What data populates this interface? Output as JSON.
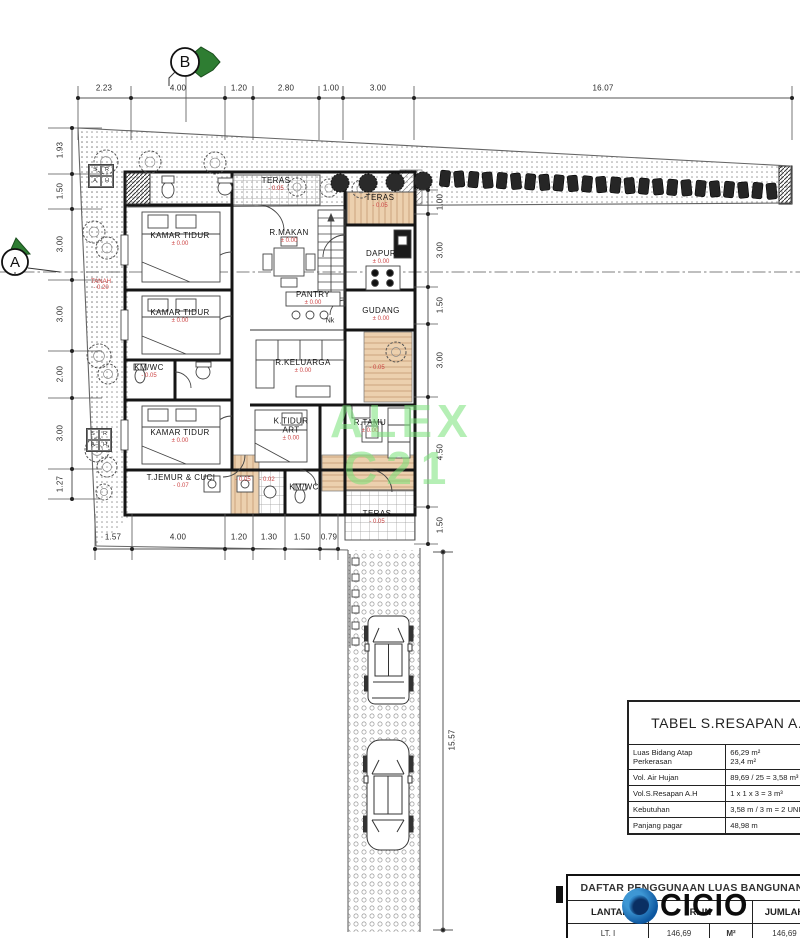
{
  "markers": {
    "a": "A",
    "b": "B"
  },
  "dims": {
    "top": [
      "2.23",
      "4.00",
      "1.20",
      "2.80",
      "1.00",
      "3.00",
      "16.07"
    ],
    "left": [
      "1.93",
      "1.50",
      "3.00",
      "3.00",
      "2.00",
      "3.00",
      "1.27"
    ],
    "right": [
      "1.00",
      "3.00",
      "1.50",
      "3.00",
      "4.50",
      "1.50"
    ],
    "bottom": [
      "1.57",
      "4.00",
      "1.20",
      "1.30",
      "1.50",
      "0.79"
    ],
    "driveway": "15.57"
  },
  "rooms": [
    {
      "name": "TERAS",
      "level": "- 0.05"
    },
    {
      "name": "R.MAKAN",
      "level": "± 0.00"
    },
    {
      "name": "TERAS",
      "level": "- 0.05"
    },
    {
      "name": "DAPUR",
      "level": "± 0.00"
    },
    {
      "name": "KAMAR TIDUR",
      "level": "± 0.00"
    },
    {
      "name": "PANTRY",
      "level": "± 0.00"
    },
    {
      "name": "KAMAR TIDUR",
      "level": "± 0.00"
    },
    {
      "name": "GUDANG",
      "level": "± 0.00"
    },
    {
      "name": "KM/WC",
      "level": "- 0.05"
    },
    {
      "name": "R.KELUARGA",
      "level": "± 0.00"
    },
    {
      "name": "KAMAR TIDUR",
      "level": "± 0.00"
    },
    {
      "name": "K.TIDUR ART",
      "level": "± 0.00"
    },
    {
      "name": "R.TAMU",
      "level": "± 0.00"
    },
    {
      "name": "T.JEMUR & CUCI",
      "level": "- 0.07"
    },
    {
      "name": "KM/WC",
      "level": ""
    },
    {
      "name": "TERAS",
      "level": "- 0.05"
    }
  ],
  "site": {
    "tanah": "TANAH",
    "tanah_level": "- 0.20",
    "corridor_level": "- 0.05",
    "laundry_level_1": "- 0.05",
    "laundry_level_2": "- 0.02",
    "nk": "Nk",
    "resapan_box": [
      "S",
      "R",
      "A",
      "H"
    ]
  },
  "watermarks": {
    "green_line1": "ALEX",
    "green_line2": "C21",
    "brand": "OCICIO",
    "brand_visible": "CICIO"
  },
  "resapan_table": {
    "title": "TABEL S.RESAPAN A.H",
    "rows": [
      {
        "label": "Luas Bidang Atap",
        "label2": "Perkerasan",
        "value": "66,29 m²",
        "value2": "23,4  m²"
      },
      {
        "label": "Vol. Air Hujan",
        "value": "89,69 / 25 = 3,58 m³"
      },
      {
        "label": "Vol.S.Resapan A.H",
        "value": "1 x 1 x 3 = 3 m³"
      },
      {
        "label": "Kebutuhan",
        "value": "3,58 m / 3 m = 2 UNIT"
      },
      {
        "label": "Panjang pagar",
        "value": "48,98 m"
      }
    ]
  },
  "usage_table": {
    "title": "DAFTAR PENGGUNAAN LUAS BANGUNAN",
    "col_floor": "LANTAI",
    "col_room": "R. IN",
    "col_total": "JUMLAH",
    "row": {
      "floor": "LT. I",
      "area": "146,69",
      "unit": "M²",
      "total": "146,69"
    }
  }
}
